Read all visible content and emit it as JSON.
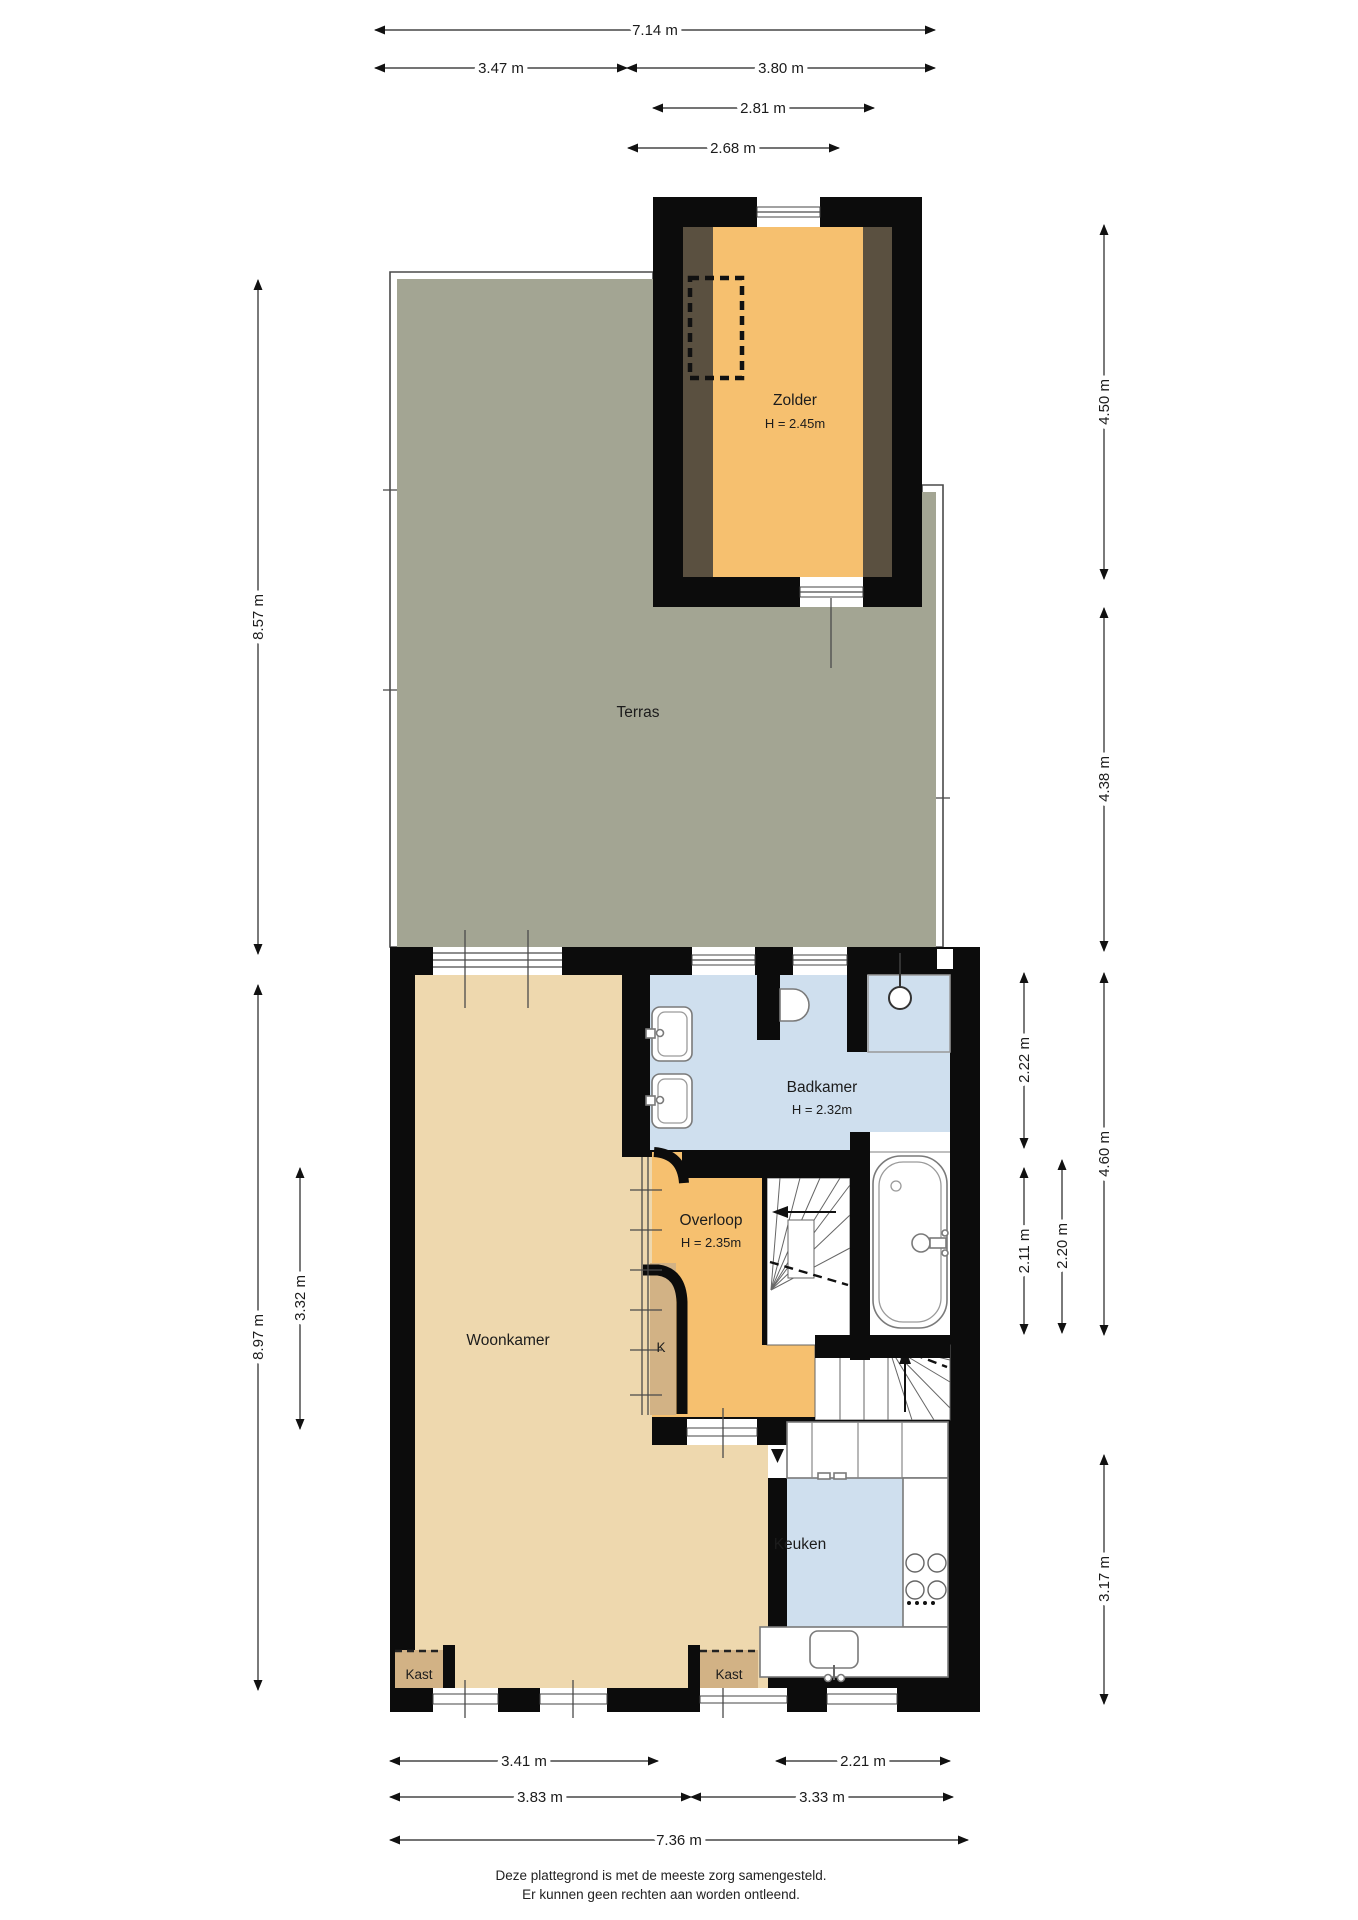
{
  "plan": {
    "rooms": {
      "zolder": {
        "name": "Zolder",
        "height": "H = 2.45m"
      },
      "terras": {
        "name": "Terras"
      },
      "badkamer": {
        "name": "Badkamer",
        "height": "H = 2.32m"
      },
      "overloop": {
        "name": "Overloop",
        "height": "H = 2.35m"
      },
      "woonkamer": {
        "name": "Woonkamer"
      },
      "keuken": {
        "name": "Keuken"
      },
      "kast_left": {
        "name": "Kast"
      },
      "kast_right": {
        "name": "Kast"
      },
      "closet_k": {
        "name": "K"
      }
    },
    "dimensions": {
      "top": {
        "total": "7.14 m",
        "left": "3.47 m",
        "right": "3.80 m",
        "attic_outer": "2.81 m",
        "attic_inner": "2.68 m"
      },
      "left": {
        "terras": "8.57 m",
        "woonkamer": "8.97 m",
        "inner": "3.32 m"
      },
      "right": {
        "zolder": "4.50 m",
        "terras": "4.38 m",
        "badkamer": "2.22 m",
        "hall_total": "4.60 m",
        "hall_a": "2.11 m",
        "hall_b": "2.20 m",
        "keuken": "3.17 m"
      },
      "bottom": {
        "woonkamer_inner": "3.41 m",
        "keuken_inner": "2.21 m",
        "woonkamer_outer": "3.83 m",
        "keuken_outer": "3.33 m",
        "total": "7.36 m"
      }
    },
    "footer": {
      "line1": "Deze plattegrond is met de meeste zorg samengesteld.",
      "line2": "Er kunnen geen rechten aan worden ontleend."
    },
    "colors": {
      "wall": "#0c0c0c",
      "wood": "#eed8ae",
      "orange": "#f6c06f",
      "tan": "#d2b285",
      "blue": "#cfdfee",
      "terrace": "#a3a593",
      "attic_slope": "#5a5040"
    }
  }
}
